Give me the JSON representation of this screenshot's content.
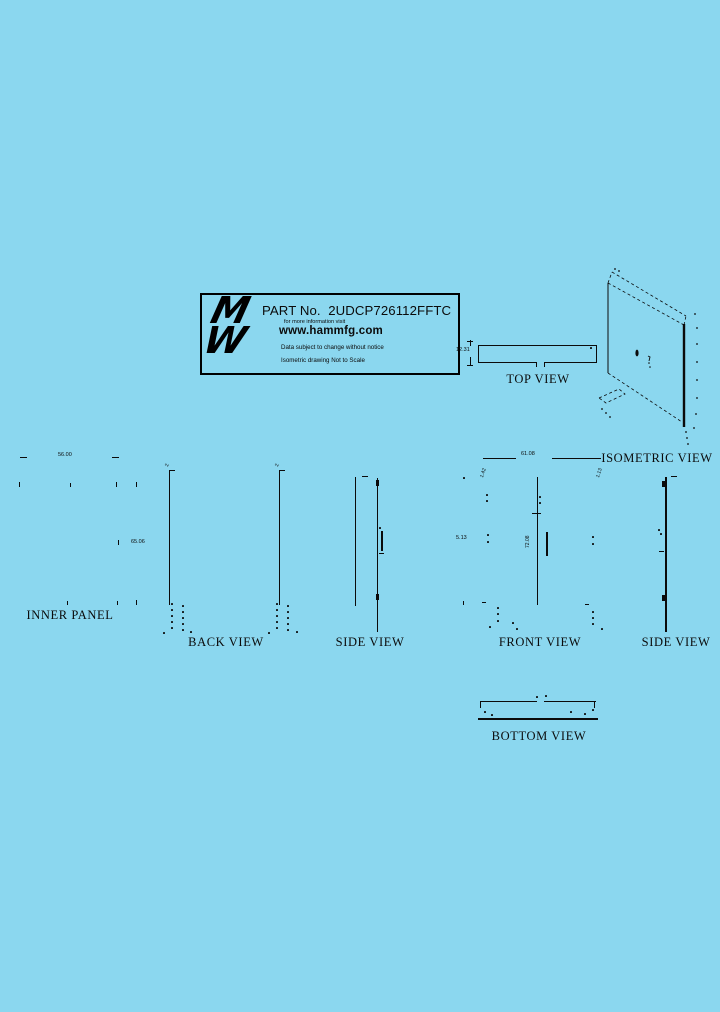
{
  "colors": {
    "background": "#8BD7EF",
    "ink": "#0B0B0B"
  },
  "title_block": {
    "part_label": "PART No.  2UDCP726112FFTC",
    "info_line": "for more information visit",
    "website": "www.hammfg.com",
    "disclaimer": "Data subject to change without notice",
    "scale_note": "Isometric drawing Not to Scale",
    "logo_letters": {
      "top": "M",
      "bottom": "W"
    }
  },
  "views": {
    "top": {
      "label": "TOP VIEW",
      "depth_dim": "12.31"
    },
    "isometric": {
      "label": "ISOMETRIC VIEW"
    },
    "inner_panel": {
      "label": "INNER PANEL",
      "width_dim": "56.00",
      "height_dim": "65.06"
    },
    "back": {
      "label": "BACK VIEW",
      "left_corner_dim": "2",
      "right_corner_dim": "2"
    },
    "side_left": {
      "label": "SIDE VIEW"
    },
    "front": {
      "label": "FRONT VIEW",
      "width_dim": "61.08",
      "height_dim": "72.08",
      "panel_dim": "5.13",
      "left_corner_dim": "1.42",
      "right_corner_dim": "1.13"
    },
    "side_right": {
      "label": "SIDE VIEW"
    },
    "bottom": {
      "label": "BOTTOM VIEW"
    }
  }
}
